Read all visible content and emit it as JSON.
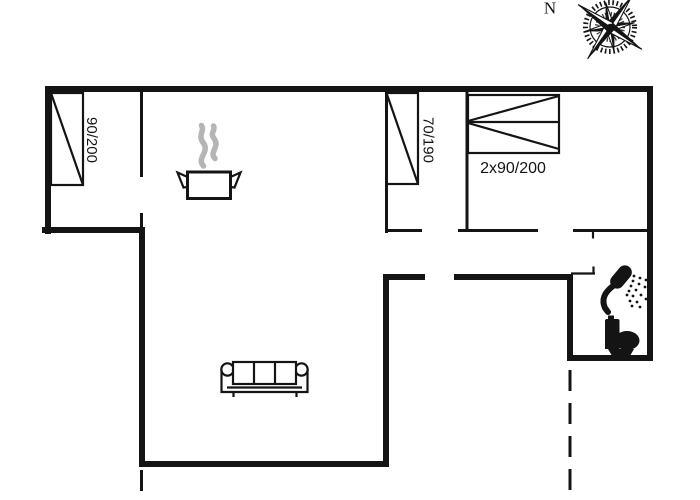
{
  "compass": {
    "north_label": "N"
  },
  "beds": [
    {
      "id": "bed-single-left",
      "label": "90/200"
    },
    {
      "id": "bed-single-middle",
      "label": "70/190"
    },
    {
      "id": "bed-double-right",
      "label": "2x90/200"
    }
  ],
  "icons": [
    {
      "name": "compass-rose-icon"
    },
    {
      "name": "cooking-pot-icon"
    },
    {
      "name": "steam-icon"
    },
    {
      "name": "sofa-icon"
    },
    {
      "name": "shower-icon"
    },
    {
      "name": "toilet-icon"
    }
  ],
  "colors": {
    "line": "#141414",
    "steam": "#b5b5b5",
    "background": "#ffffff"
  }
}
